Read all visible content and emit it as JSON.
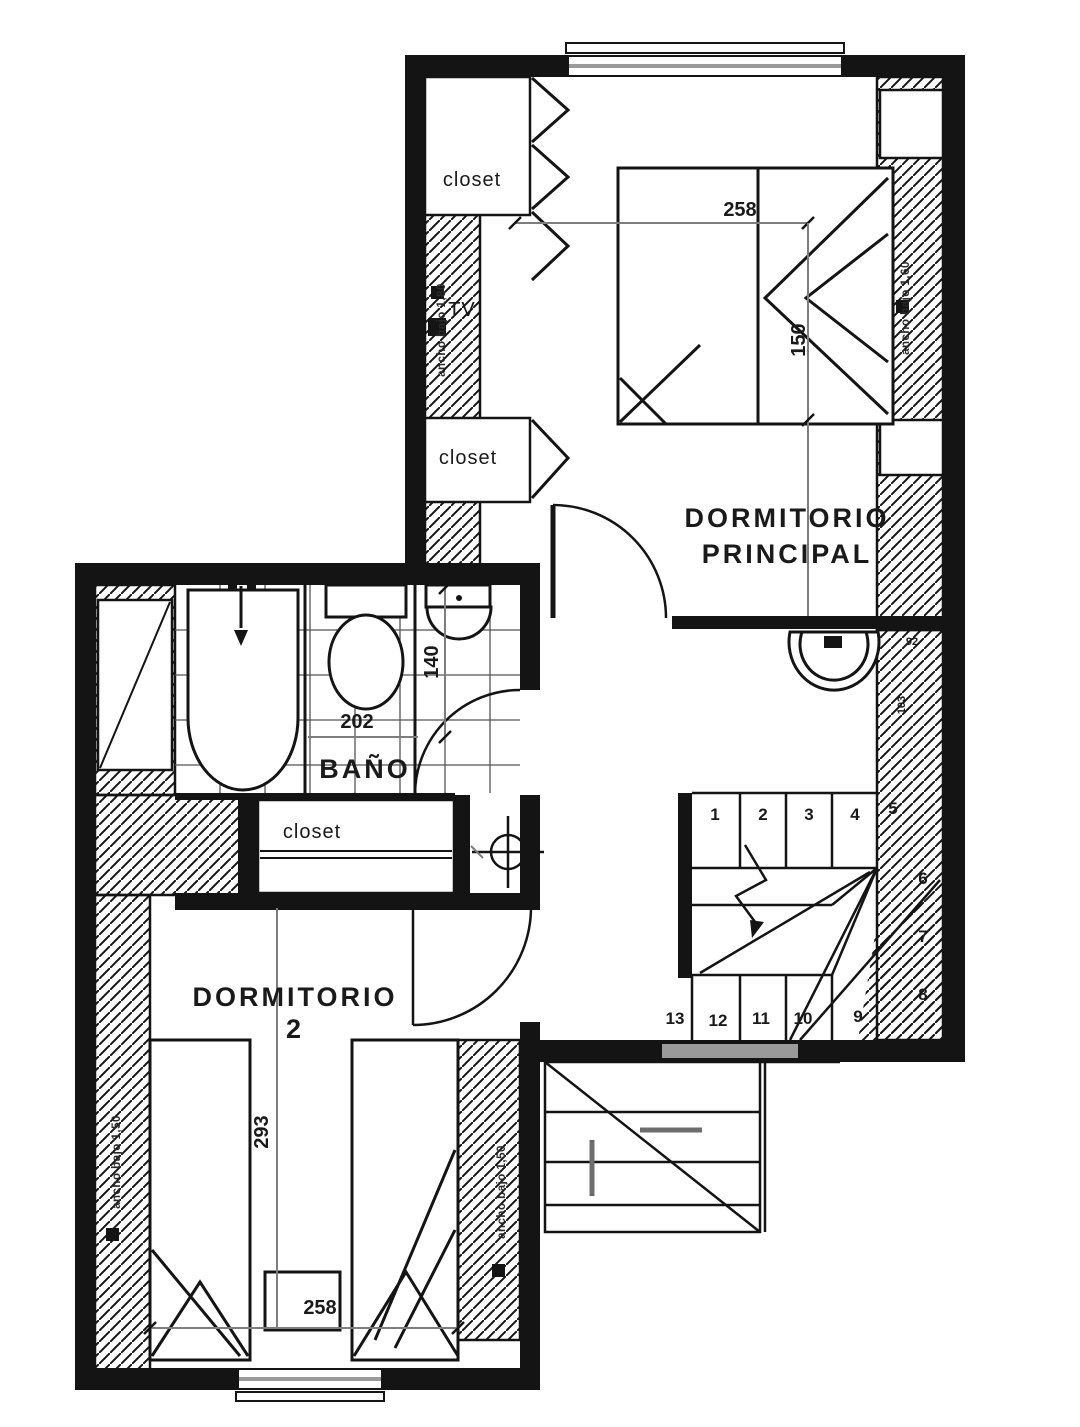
{
  "plan": {
    "texts": {
      "room_master_1": "DORMITORIO",
      "room_master_2": "PRINCIPAL",
      "room_bath": "BAÑO",
      "room_dorm2_1": "DORMITORIO",
      "room_dorm2_2": "2",
      "closet_master_top": "closet",
      "closet_master_mid": "closet",
      "closet_hall": "closet",
      "tv": "TV",
      "dim_master_width": "258",
      "dim_master_bed": "150",
      "dim_bath_width": "202",
      "dim_bath_depth": "140",
      "dim_dorm2_depth": "293",
      "dim_dorm2_width": "258",
      "dim_niche_width": "92",
      "dim_niche_depth": "103",
      "note_master_left": "ancho bajo 1,80",
      "note_master_right": "ancho bajo 1,60",
      "note_dorm2_left": "ancho bajo 1,50",
      "note_dorm2_right": "ancho bajo 1,50",
      "stairs_top": [
        "1",
        "2",
        "3",
        "4",
        "5"
      ],
      "stairs_side": [
        "6",
        "7",
        "8"
      ],
      "stairs_bottom": [
        "13",
        "12",
        "11",
        "10",
        "9"
      ]
    },
    "colors": {
      "line": "#141414",
      "dimension": "#7d7d7d",
      "paper": "#ffffff",
      "window_band": "#9a9a9a"
    }
  }
}
